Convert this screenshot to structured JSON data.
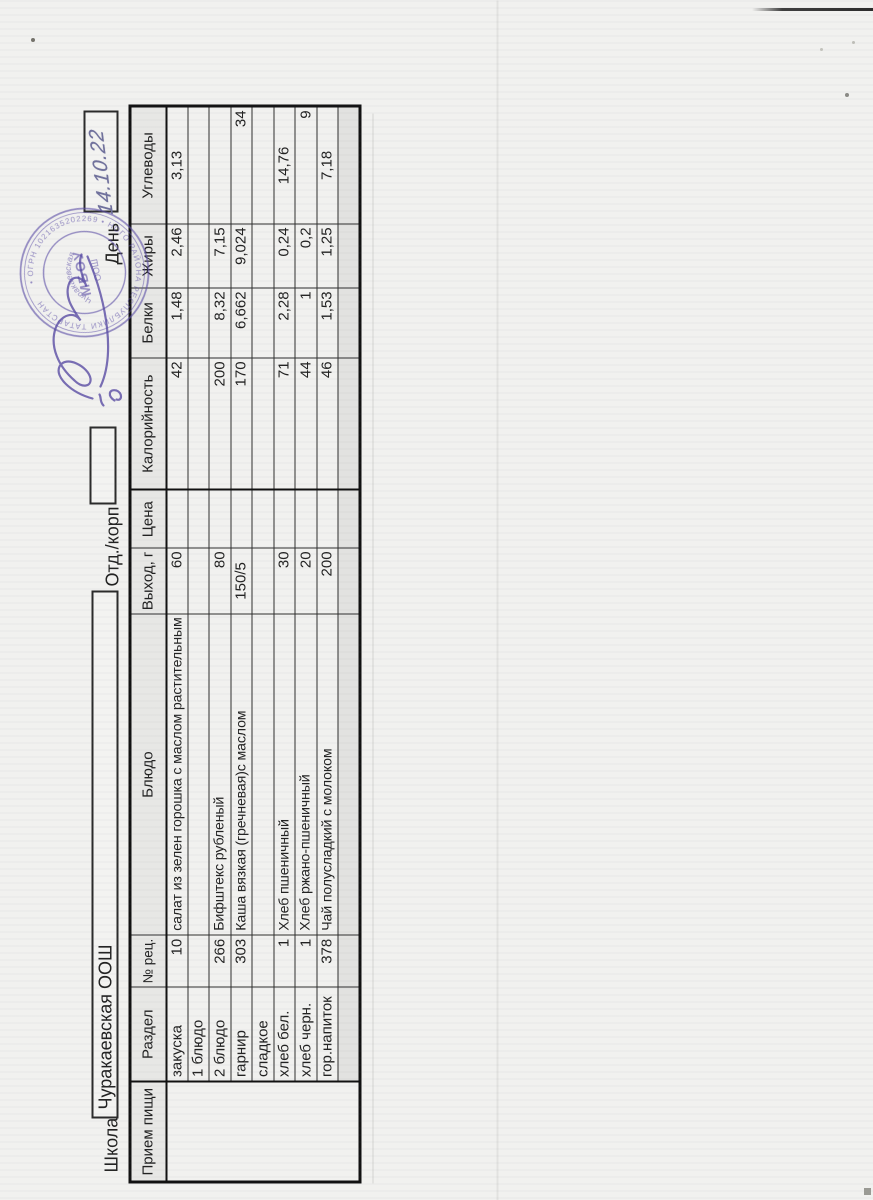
{
  "header": {
    "school_label": "Школа",
    "school_name": "Чуракаевская ООШ",
    "dept_label": "Отд./корп",
    "day_label": "День",
    "day_value": "14.10.22"
  },
  "table": {
    "columns": [
      "Прием пищи",
      "Раздел",
      "№ рец.",
      "Блюдо",
      "Выход, г",
      "Цена",
      "Калорийность",
      "Белки",
      "Жиры",
      "Углеводы"
    ],
    "rows": [
      {
        "section": "закуска",
        "rec": "10",
        "dish": "салат из зелен горошка с маслом растительным",
        "output": "60",
        "price": "",
        "cal": "42",
        "protein": "1,48",
        "fat": "2,46",
        "carbs": "3,13"
      },
      {
        "section": "1 блюдо",
        "rec": "",
        "dish": "",
        "output": "",
        "price": "",
        "cal": "",
        "protein": "",
        "fat": "",
        "carbs": ""
      },
      {
        "section": "2 блюдо",
        "rec": "266",
        "dish": "Бифштекс рубленый",
        "output": "80",
        "price": "",
        "cal": "200",
        "protein": "8,32",
        "fat": "7,15",
        "carbs": ""
      },
      {
        "section": "гарнир",
        "rec": "303",
        "dish": "Каша вязкая (гречневая)с маслом",
        "output": "150/5",
        "price": "",
        "cal": "170",
        "protein": "6,662",
        "fat": "9,024",
        "carbs": "34"
      },
      {
        "section": "сладкое",
        "rec": "",
        "dish": "",
        "output": "",
        "price": "",
        "cal": "",
        "protein": "",
        "fat": "",
        "carbs": ""
      },
      {
        "section": "хлеб бел.",
        "rec": "1",
        "dish": "Хлеб пшеничный",
        "output": "30",
        "price": "",
        "cal": "71",
        "protein": "2,28",
        "fat": "0,24",
        "carbs": "14,76"
      },
      {
        "section": "хлеб черн.",
        "rec": "1",
        "dish": "Хлеб ржано-пшеничный",
        "output": "20",
        "price": "",
        "cal": "44",
        "protein": "1",
        "fat": "0,2",
        "carbs": "9"
      },
      {
        "section": "гор.напиток",
        "rec": "378",
        "dish": "Чай полусладкий с молоком",
        "output": "200",
        "price": "",
        "cal": "46",
        "protein": "1,53",
        "fat": "1,25",
        "carbs": "7,18"
      },
      {
        "section": "",
        "rec": "",
        "dish": "",
        "output": "",
        "price": "",
        "cal": "",
        "protein": "",
        "fat": "",
        "carbs": ""
      }
    ]
  },
  "stamp": {
    "ring_text": "• ОГРН 1021635202269 • НОГО РАЙОНА РЕСПУБЛИКИ ТАТАРСТАН",
    "inner_arc_text": "Чуракаевская",
    "center_text": "МБОУ",
    "sub_text": "ООШ"
  },
  "colors": {
    "paper": "#f1f1ef",
    "ink": "#222222",
    "stamp": "#5e50a8",
    "signature": "#5a4da5",
    "handwriting": "#70719c"
  }
}
